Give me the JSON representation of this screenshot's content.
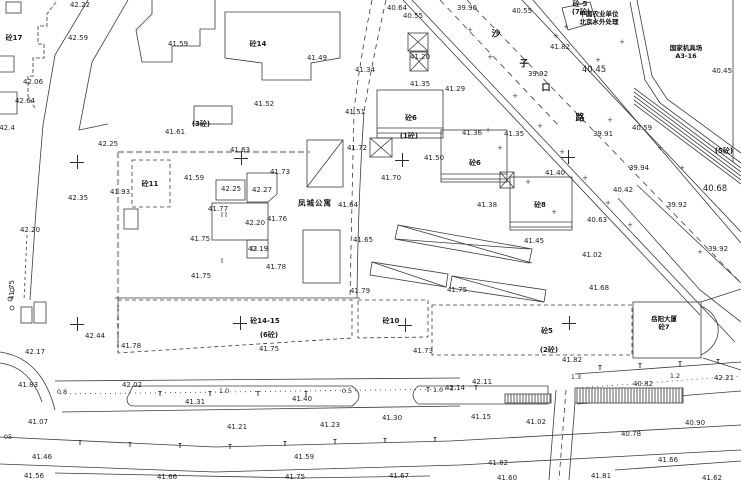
{
  "map": {
    "background": "#ffffff",
    "line_color": "#3b3b3b",
    "fence_color": "#ababab"
  },
  "annotations": {
    "fengcheng": "凤城公寓",
    "yueyang": [
      "岳阳大厦",
      "砼7"
    ],
    "agri": [
      "中国农业单位",
      "北京水外处理"
    ],
    "depot": [
      "国家机具场",
      "A3-16"
    ],
    "road_chars": [
      {
        "t": "沙",
        "x": 496,
        "y": 33
      },
      {
        "t": "子",
        "x": 524,
        "y": 63
      },
      {
        "t": "口",
        "x": 546,
        "y": 87
      },
      {
        "t": "路",
        "x": 580,
        "y": 117
      }
    ]
  },
  "labels": [
    {
      "t": "42.22",
      "x": 80,
      "y": 5
    },
    {
      "t": "砼17",
      "x": 14,
      "y": 38,
      "c": "b"
    },
    {
      "t": "42.59",
      "x": 78,
      "y": 38
    },
    {
      "t": "41.59",
      "x": 178,
      "y": 44
    },
    {
      "t": "42.06",
      "x": 33,
      "y": 82
    },
    {
      "t": "42.64",
      "x": 25,
      "y": 101
    },
    {
      "t": "42.4",
      "x": 7,
      "y": 128
    },
    {
      "t": "42.25",
      "x": 108,
      "y": 144
    },
    {
      "t": "41.61",
      "x": 175,
      "y": 132
    },
    {
      "t": "(3砼)",
      "x": 201,
      "y": 124,
      "c": "b"
    },
    {
      "t": "42.35",
      "x": 78,
      "y": 198
    },
    {
      "t": "41.93",
      "x": 120,
      "y": 192
    },
    {
      "t": "42.20",
      "x": 30,
      "y": 230
    },
    {
      "t": "41.75",
      "x": 12,
      "y": 290,
      "c": "r"
    },
    {
      "t": "42.17",
      "x": 35,
      "y": 352
    },
    {
      "t": "42.44",
      "x": 95,
      "y": 336
    },
    {
      "t": "41.78",
      "x": 131,
      "y": 346
    },
    {
      "t": "41.83",
      "x": 28,
      "y": 385
    },
    {
      "t": "0.8",
      "x": 62,
      "y": 392,
      "c": "s"
    },
    {
      "t": "42.02",
      "x": 132,
      "y": 385
    },
    {
      "t": "41.31",
      "x": 195,
      "y": 402
    },
    {
      "t": "1.0",
      "x": 224,
      "y": 391,
      "c": "s"
    },
    {
      "t": "41.07",
      "x": 38,
      "y": 422
    },
    {
      "t": "05",
      "x": 8,
      "y": 437,
      "c": "s"
    },
    {
      "t": "41.46",
      "x": 42,
      "y": 457
    },
    {
      "t": "41.56",
      "x": 34,
      "y": 476
    },
    {
      "t": "41.66",
      "x": 167,
      "y": 477
    },
    {
      "t": "砼14",
      "x": 258,
      "y": 44,
      "c": "b"
    },
    {
      "t": "41.49",
      "x": 317,
      "y": 58
    },
    {
      "t": "41.52",
      "x": 264,
      "y": 104
    },
    {
      "t": "41.51",
      "x": 355,
      "y": 112
    },
    {
      "t": "41.34",
      "x": 365,
      "y": 70
    },
    {
      "t": "40.64",
      "x": 397,
      "y": 8
    },
    {
      "t": "40.55",
      "x": 413,
      "y": 16
    },
    {
      "t": "41.63",
      "x": 240,
      "y": 150
    },
    {
      "t": "41.59",
      "x": 194,
      "y": 178
    },
    {
      "t": "42.25",
      "x": 231,
      "y": 189
    },
    {
      "t": "42.27",
      "x": 262,
      "y": 190
    },
    {
      "t": "41.73",
      "x": 280,
      "y": 172
    },
    {
      "t": "41.77",
      "x": 218,
      "y": 209
    },
    {
      "t": "42.20",
      "x": 255,
      "y": 223
    },
    {
      "t": "41.75",
      "x": 200,
      "y": 239
    },
    {
      "t": "42.19",
      "x": 258,
      "y": 249
    },
    {
      "t": "41.76",
      "x": 277,
      "y": 219
    },
    {
      "t": "41.78",
      "x": 276,
      "y": 267
    },
    {
      "t": "41.75",
      "x": 201,
      "y": 276
    },
    {
      "t": "41.64",
      "x": 348,
      "y": 205
    },
    {
      "t": "41.72",
      "x": 357,
      "y": 148
    },
    {
      "t": "41.70",
      "x": 391,
      "y": 178
    },
    {
      "t": "41.65",
      "x": 363,
      "y": 240
    },
    {
      "t": "砼11",
      "x": 150,
      "y": 184,
      "c": "b"
    },
    {
      "t": "(1砼)",
      "x": 409,
      "y": 136,
      "c": "b"
    },
    {
      "t": "41.35",
      "x": 514,
      "y": 134
    },
    {
      "t": "41.50",
      "x": 434,
      "y": 158
    },
    {
      "t": "砼6",
      "x": 411,
      "y": 118,
      "c": "b"
    },
    {
      "t": "砼6",
      "x": 475,
      "y": 163,
      "c": "b"
    },
    {
      "t": "41.40",
      "x": 555,
      "y": 173
    },
    {
      "t": "41.38",
      "x": 487,
      "y": 205
    },
    {
      "t": "砼8",
      "x": 540,
      "y": 205,
      "c": "b"
    },
    {
      "t": "41.45",
      "x": 534,
      "y": 241
    },
    {
      "t": "41.29",
      "x": 455,
      "y": 89
    },
    {
      "t": "41.20",
      "x": 420,
      "y": 57
    },
    {
      "t": "41.35",
      "x": 420,
      "y": 84
    },
    {
      "t": "41.36",
      "x": 472,
      "y": 133
    },
    {
      "t": "39.96",
      "x": 467,
      "y": 8
    },
    {
      "t": "40.55",
      "x": 522,
      "y": 11
    },
    {
      "t": "41.82",
      "x": 560,
      "y": 47
    },
    {
      "t": "砼-5",
      "x": 580,
      "y": 4,
      "c": "b"
    },
    {
      "t": "(7砼)",
      "x": 581,
      "y": 12,
      "c": "b"
    },
    {
      "t": "40.45",
      "x": 594,
      "y": 70,
      "c": "g"
    },
    {
      "t": "40.45",
      "x": 722,
      "y": 71
    },
    {
      "t": "39.92",
      "x": 538,
      "y": 74
    },
    {
      "t": "40.59",
      "x": 642,
      "y": 128
    },
    {
      "t": "39.91",
      "x": 603,
      "y": 134
    },
    {
      "t": "39.94",
      "x": 639,
      "y": 168
    },
    {
      "t": "40.42",
      "x": 623,
      "y": 190
    },
    {
      "t": "40.68",
      "x": 715,
      "y": 189,
      "c": "g"
    },
    {
      "t": "39.92",
      "x": 677,
      "y": 205
    },
    {
      "t": "40.63",
      "x": 597,
      "y": 220
    },
    {
      "t": "39.92",
      "x": 718,
      "y": 249
    },
    {
      "t": "41.02",
      "x": 592,
      "y": 255
    },
    {
      "t": "(5砼)",
      "x": 724,
      "y": 151,
      "c": "b"
    },
    {
      "t": "41.68",
      "x": 599,
      "y": 288
    },
    {
      "t": "砼14-15",
      "x": 265,
      "y": 321,
      "c": "b"
    },
    {
      "t": "(6砼)",
      "x": 269,
      "y": 335,
      "c": "b"
    },
    {
      "t": "41.75",
      "x": 269,
      "y": 349
    },
    {
      "t": "砼10",
      "x": 391,
      "y": 321,
      "c": "b"
    },
    {
      "t": "41.73",
      "x": 423,
      "y": 351
    },
    {
      "t": "41.79",
      "x": 360,
      "y": 291
    },
    {
      "t": "41.75",
      "x": 457,
      "y": 290
    },
    {
      "t": "砼5",
      "x": 547,
      "y": 331,
      "c": "b"
    },
    {
      "t": "(2砼)",
      "x": 549,
      "y": 350,
      "c": "b"
    },
    {
      "t": "41.82",
      "x": 572,
      "y": 360
    },
    {
      "t": "1.3",
      "x": 576,
      "y": 377,
      "c": "s"
    },
    {
      "t": "1.2",
      "x": 675,
      "y": 376,
      "c": "s"
    },
    {
      "t": "42.21",
      "x": 724,
      "y": 378
    },
    {
      "t": "40.82",
      "x": 643,
      "y": 384
    },
    {
      "t": "40.90",
      "x": 695,
      "y": 423
    },
    {
      "t": "40.78",
      "x": 631,
      "y": 434
    },
    {
      "t": "41.02",
      "x": 536,
      "y": 422
    },
    {
      "t": "41.66",
      "x": 668,
      "y": 460
    },
    {
      "t": "41.62",
      "x": 712,
      "y": 478
    },
    {
      "t": "41.81",
      "x": 601,
      "y": 476
    },
    {
      "t": "41.60",
      "x": 507,
      "y": 478
    },
    {
      "t": "41.82",
      "x": 498,
      "y": 463
    },
    {
      "t": "0.5",
      "x": 347,
      "y": 391,
      "c": "s"
    },
    {
      "t": "41.40",
      "x": 302,
      "y": 399
    },
    {
      "t": "1.0",
      "x": 438,
      "y": 390,
      "c": "s"
    },
    {
      "t": "42.14",
      "x": 455,
      "y": 388
    },
    {
      "t": "42.11",
      "x": 482,
      "y": 382
    },
    {
      "t": "41.30",
      "x": 392,
      "y": 418
    },
    {
      "t": "41.15",
      "x": 481,
      "y": 417
    },
    {
      "t": "41.23",
      "x": 330,
      "y": 425
    },
    {
      "t": "41.21",
      "x": 237,
      "y": 427
    },
    {
      "t": "41.59",
      "x": 304,
      "y": 457
    },
    {
      "t": "41.75",
      "x": 295,
      "y": 477
    },
    {
      "t": "41.67",
      "x": 399,
      "y": 476
    }
  ],
  "crosses": [
    {
      "x": 77,
      "y": 162
    },
    {
      "x": 241,
      "y": 158
    },
    {
      "x": 402,
      "y": 160
    },
    {
      "x": 568,
      "y": 157
    },
    {
      "x": 77,
      "y": 324
    },
    {
      "x": 240,
      "y": 323
    },
    {
      "x": 405,
      "y": 325
    },
    {
      "x": 569,
      "y": 323
    }
  ],
  "plus_marks": [
    {
      "x": 470,
      "y": 30
    },
    {
      "x": 490,
      "y": 57
    },
    {
      "x": 515,
      "y": 96
    },
    {
      "x": 540,
      "y": 126
    },
    {
      "x": 562,
      "y": 152
    },
    {
      "x": 585,
      "y": 178
    },
    {
      "x": 608,
      "y": 203
    },
    {
      "x": 630,
      "y": 225
    },
    {
      "x": 500,
      "y": 148
    },
    {
      "x": 528,
      "y": 182
    },
    {
      "x": 554,
      "y": 212
    },
    {
      "x": 598,
      "y": 60
    },
    {
      "x": 622,
      "y": 42
    },
    {
      "x": 660,
      "y": 148
    },
    {
      "x": 682,
      "y": 168
    },
    {
      "x": 700,
      "y": 252
    },
    {
      "x": 556,
      "y": 36
    },
    {
      "x": 566,
      "y": 27
    },
    {
      "x": 488,
      "y": 130
    },
    {
      "x": 610,
      "y": 120
    }
  ],
  "lamp_ticks": [
    {
      "x": 80,
      "y": 445
    },
    {
      "x": 130,
      "y": 447
    },
    {
      "x": 180,
      "y": 448
    },
    {
      "x": 230,
      "y": 449
    },
    {
      "x": 285,
      "y": 446
    },
    {
      "x": 335,
      "y": 444
    },
    {
      "x": 385,
      "y": 443
    },
    {
      "x": 435,
      "y": 442
    },
    {
      "x": 600,
      "y": 370
    },
    {
      "x": 640,
      "y": 368
    },
    {
      "x": 680,
      "y": 366
    },
    {
      "x": 718,
      "y": 364
    },
    {
      "x": 160,
      "y": 396
    },
    {
      "x": 210,
      "y": 396
    },
    {
      "x": 258,
      "y": 396
    },
    {
      "x": 306,
      "y": 396
    },
    {
      "x": 428,
      "y": 392
    },
    {
      "x": 452,
      "y": 391
    },
    {
      "x": 476,
      "y": 390
    }
  ]
}
